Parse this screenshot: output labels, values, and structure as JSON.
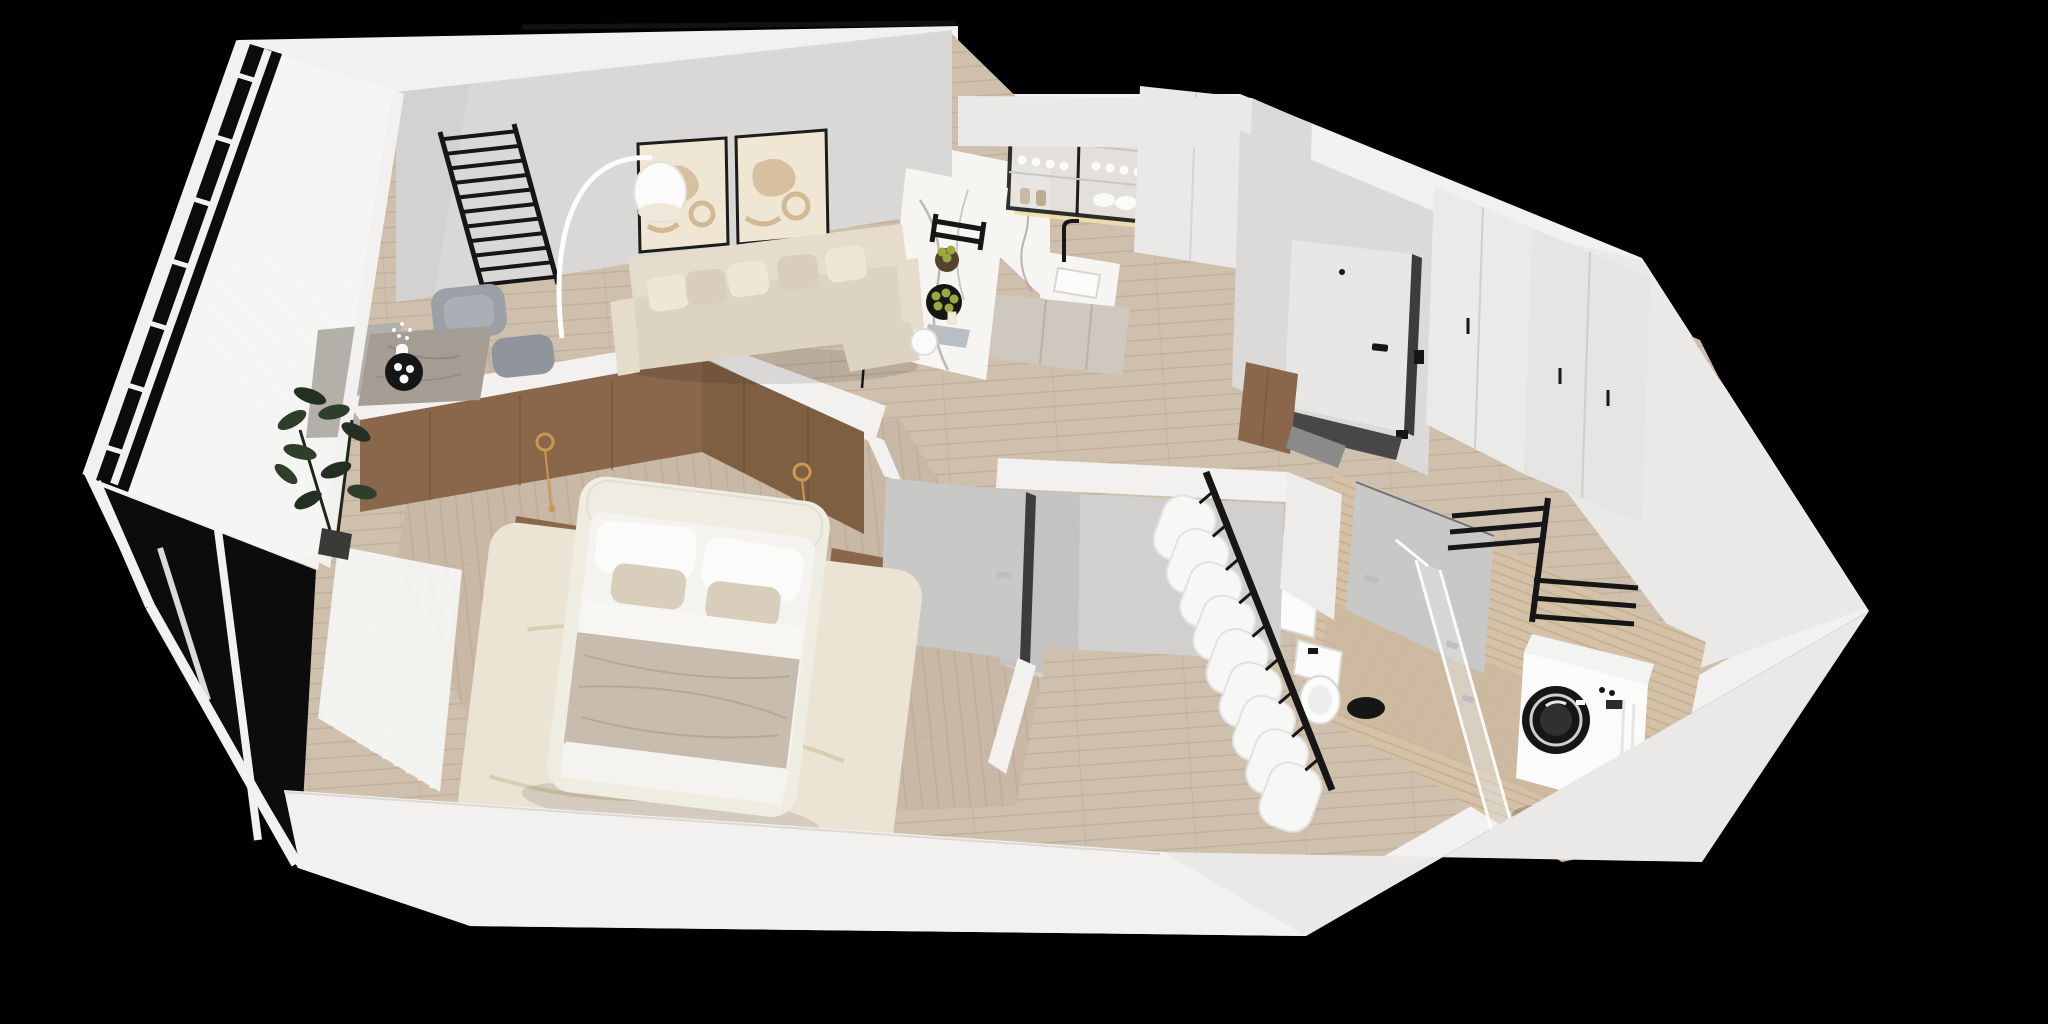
{
  "meta": {
    "title": "3d-apartment-floor-plan-render",
    "canvas": {
      "width": 2048,
      "height": 1024
    },
    "view": "isometric-cutaway-top-down",
    "background": "#000000"
  },
  "colors": {
    "bg": "#000000",
    "wallTop": "#f2f1ef",
    "wallLight": "#eae9e7",
    "wallMid": "#dbdad8",
    "wallShade": "#cfcecc",
    "innerWall": "#d1d0ce",
    "backWall": "#d9d8d6",
    "floorWood": "#cfc0ae",
    "floorWoodLine": "#b9a892",
    "floorWoodDark": "#c8b8a5",
    "balconyStone": "#b3b0aa",
    "glassDark": "#0c0c0c",
    "travertine": "#d4c1a7",
    "travertineLine": "#c0a888",
    "travertineFloor": "#cdb9a0",
    "marbleWhite": "#f6f5f2",
    "marbleVein": "#aaa49c",
    "marbleGray": "#a59d94",
    "cabinetBeige": "#cfc8be",
    "sofaBeige": "#ddd3c1",
    "sofaBack": "#e5dccb",
    "pillowCream": "#efe6d4",
    "pillowTaupe": "#d9cdbb",
    "walnut": "#8a674a",
    "walnutRight": "#7f5f41",
    "walnutDark": "#6f5138",
    "bedWhite": "#f5f3ef",
    "duvetTaupe": "#c8bcae",
    "rugCream": "#ebe3d3",
    "rugLine": "#dbcdb4",
    "boucle": "#efece2",
    "black": "#161616",
    "gold": "#c79a52",
    "plantGreen": "#2f3d2c",
    "plantDark": "#233021",
    "chairGray": "#9aa0a6",
    "chairGray2": "#8f959b",
    "doorGray": "#c8c8c6",
    "doorWhite": "#e8e7e5",
    "chrome": "#bcbfc2",
    "curtain": "#f4f4f2",
    "washerWhite": "#fbfbfa",
    "pearGreen": "#9aa83f",
    "matDark": "#474745",
    "jamb": "#3c3c3a",
    "runnerGray": "#8a8a88",
    "warmLight": "#f0dfae"
  },
  "scene": {
    "rooms": [
      {
        "id": "balcony",
        "objects": [
          "window-frames",
          "window-mullions",
          "sheer-curtains",
          "ficus-plant",
          "stone-floor"
        ]
      },
      {
        "id": "living-room",
        "objects": [
          "wall-bars-ladder",
          "art-frame-left",
          "art-frame-right",
          "arc-floor-lamp",
          "sofa",
          "throw-pillows",
          "ottoman",
          "side-table",
          "marble-desk",
          "desk-armchair",
          "lounge-chair",
          "black-tray-table",
          "vase-dried-flowers"
        ]
      },
      {
        "id": "kitchen",
        "objects": [
          "glass-front-cabinet",
          "dishware",
          "marble-backsplash",
          "under-cabinet-light",
          "sink",
          "black-faucet",
          "lower-cabinets",
          "marble-island",
          "island-towel-bar",
          "pear-pedestal-bowl",
          "pear-platter",
          "water-glass",
          "folded-towel",
          "bar-stools",
          "tall-cabinet-column"
        ]
      },
      {
        "id": "entry-hall",
        "objects": [
          "entry-door",
          "peephole",
          "door-handle",
          "door-mat",
          "light-switches",
          "wood-bench",
          "wardrobe-cabinets",
          "hall-runner"
        ]
      },
      {
        "id": "bedroom",
        "objects": [
          "walnut-headboard-wall",
          "gold-sconce-left",
          "gold-sconce-right",
          "floating-nightstand-left",
          "floating-nightstand-right",
          "magazine",
          "double-bed",
          "bed-pillows",
          "duvet",
          "area-rug",
          "bedroom-door",
          "sheer-curtain"
        ]
      },
      {
        "id": "walk-in-closet",
        "objects": [
          "clothes-rail",
          "hanging-shirts"
        ]
      },
      {
        "id": "bathroom",
        "objects": [
          "travertine-walls",
          "bathroom-door",
          "towel-ladder-rack",
          "shower-glass-panel",
          "shower-head",
          "wall-basin",
          "washing-machine",
          "toilet",
          "shower-stool"
        ]
      }
    ],
    "build": {
      "lines": [
        {
          "id": "g-mullions",
          "n": 7,
          "a": [
            242,
            42,
            88,
            476
          ],
          "b": [
            268,
            50,
            114,
            484
          ],
          "stroke": "wallTop",
          "w": 5,
          "o": 1,
          "name": "window-mullion"
        },
        {
          "id": "g-curtains-upper",
          "n": 16,
          "a": [
            290,
            62,
            398,
            94
          ],
          "b": [
            134,
            490,
            322,
            566
          ],
          "stroke": "curtain",
          "w": 5,
          "o": 0.55,
          "name": "curtain-fold"
        },
        {
          "id": "g-curtains-lower",
          "n": 10,
          "a": [
            338,
            546,
            458,
            572
          ],
          "b": [
            320,
            718,
            438,
            792
          ],
          "stroke": "curtain",
          "w": 6,
          "o": 0.85,
          "name": "curtain-fold"
        },
        {
          "id": "g-ladder-rungs",
          "n": 11,
          "a": [
            440,
            132,
            484,
            292
          ],
          "b": [
            514,
            124,
            558,
            284
          ],
          "stroke": "black",
          "w": 4,
          "o": 1,
          "name": "wall-bar-rung"
        }
      ],
      "closet": {
        "shirtCount": 9,
        "rail": [
          1206,
          472,
          1332,
          790
        ]
      }
    }
  }
}
